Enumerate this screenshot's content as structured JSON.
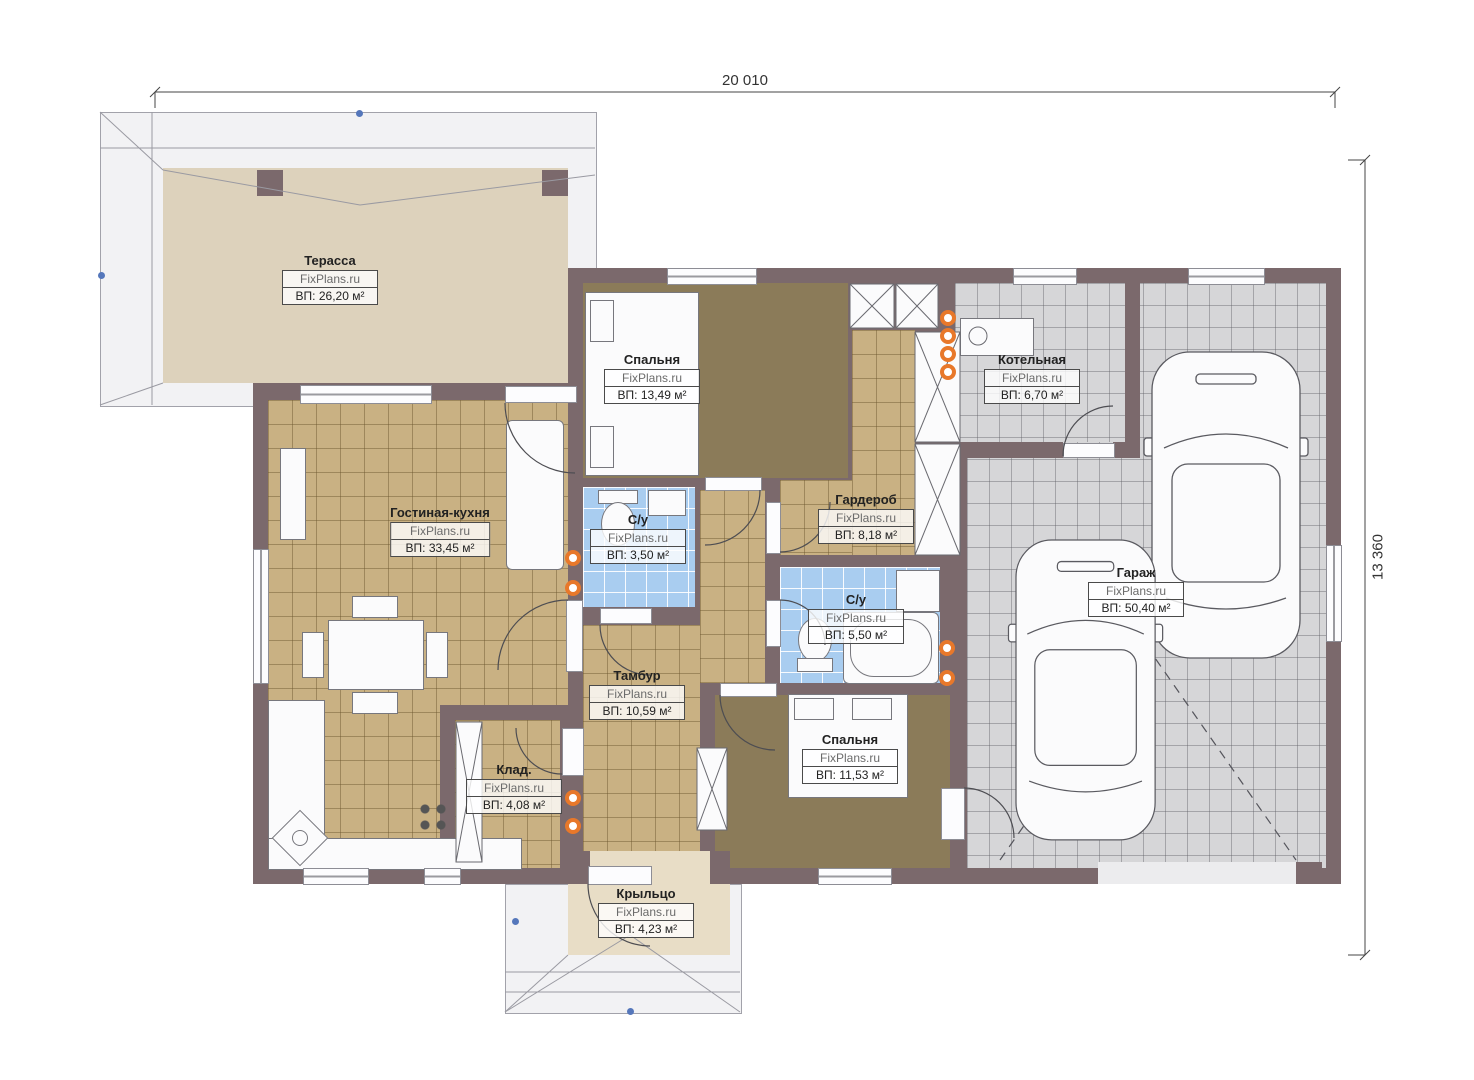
{
  "plan": {
    "brand": "FixPlans.ru",
    "dimensions": {
      "top": "20 010",
      "right": "13 360"
    },
    "rooms": [
      {
        "id": "terrace",
        "name": "Терасса",
        "area_label": "ВП: 26,20 м²"
      },
      {
        "id": "bedroom1",
        "name": "Спальня",
        "area_label": "ВП: 13,49 м²"
      },
      {
        "id": "boiler",
        "name": "Котельная",
        "area_label": "ВП: 6,70 м²"
      },
      {
        "id": "living",
        "name": "Гостиная-кухня",
        "area_label": "ВП: 33,45 м²"
      },
      {
        "id": "bath1",
        "name": "С/у",
        "area_label": "ВП: 3,50 м²"
      },
      {
        "id": "wardrobe",
        "name": "Гардероб",
        "area_label": "ВП: 8,18 м²"
      },
      {
        "id": "garage",
        "name": "Гараж",
        "area_label": "ВП: 50,40 м²"
      },
      {
        "id": "bath2",
        "name": "С/у",
        "area_label": "ВП: 5,50 м²"
      },
      {
        "id": "tambur",
        "name": "Тамбур",
        "area_label": "ВП: 10,59 м²"
      },
      {
        "id": "klad",
        "name": "Клад.",
        "area_label": "ВП: 4,08 м²"
      },
      {
        "id": "bedroom2",
        "name": "Спальня",
        "area_label": "ВП: 11,53 м²"
      },
      {
        "id": "porch",
        "name": "Крыльцо",
        "area_label": "ВП: 4,23 м²"
      }
    ],
    "colors": {
      "wall": "#7b696c",
      "tile_tan": "#c9b183",
      "carpet": "#8b7b59",
      "tile_blue": "#a9cdf0",
      "tile_grey": "#d6d6d8",
      "terrace": "#ddd2bc",
      "porch": "#e8ddc6",
      "radiator": "#e8782a",
      "axis_marker": "#5577bb"
    }
  }
}
